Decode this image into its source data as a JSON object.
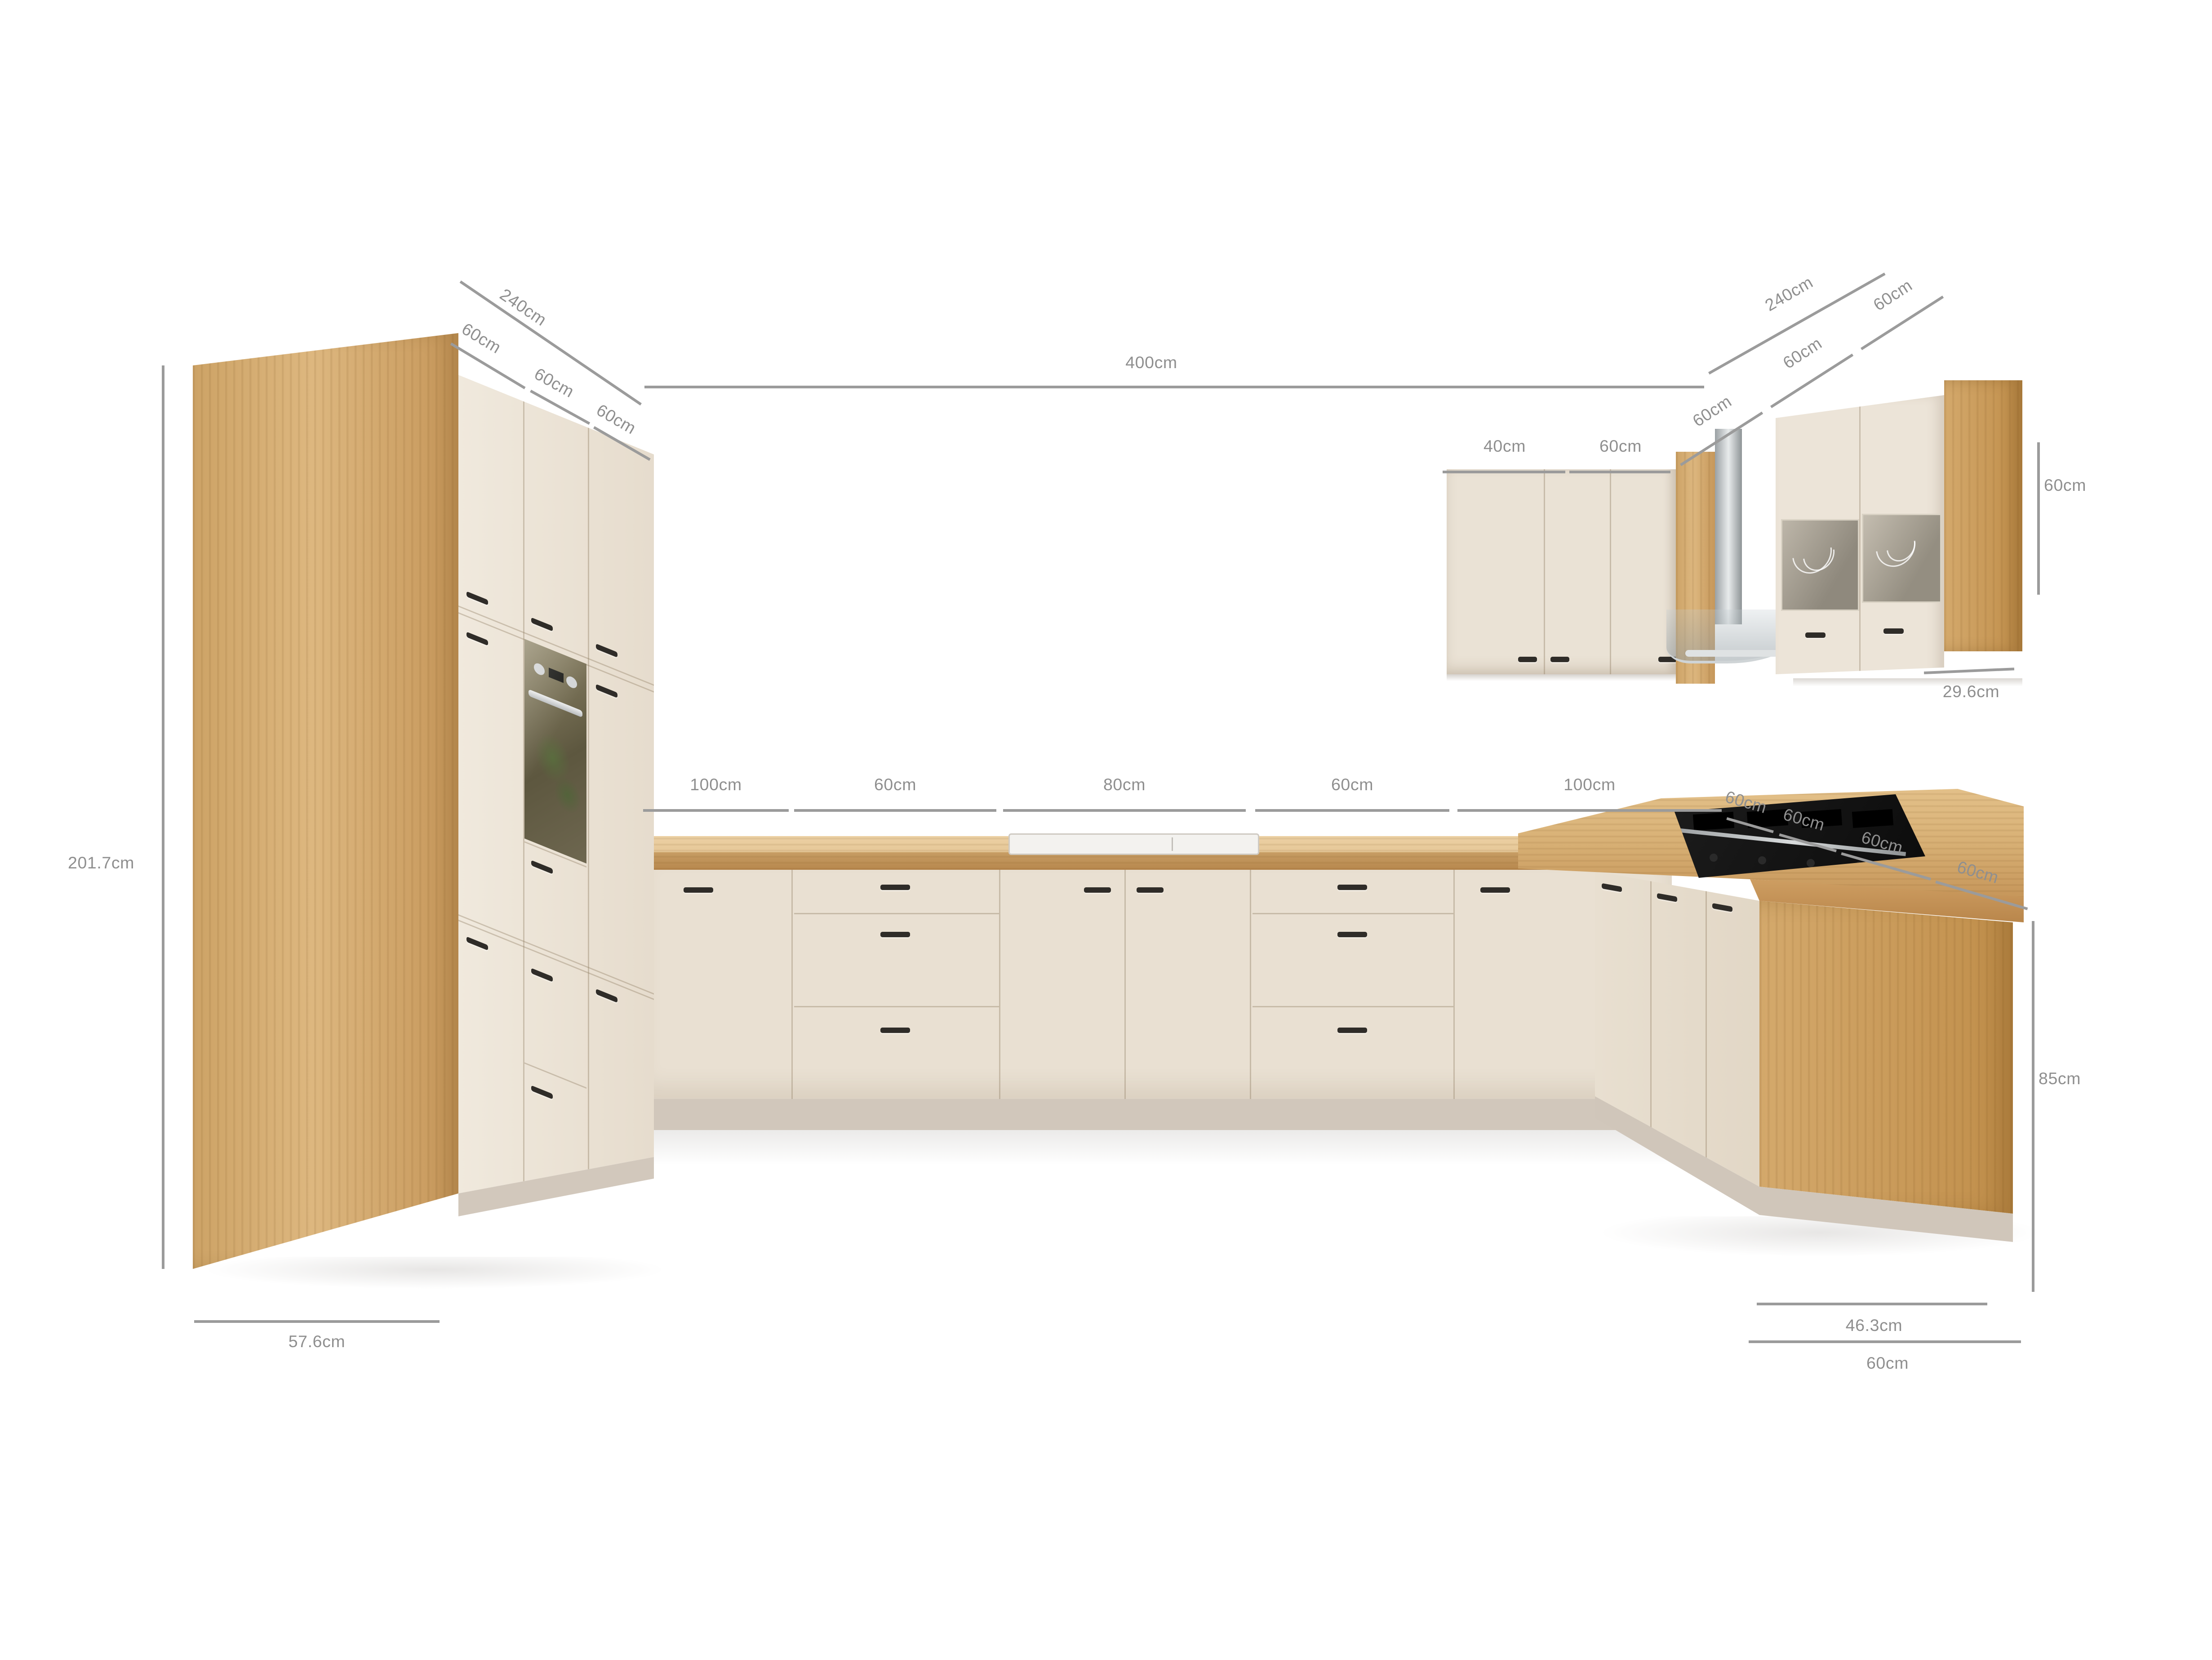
{
  "colors": {
    "wood": "#d2a76c",
    "countertop": "#d8b076",
    "cabinet_cream": "#eae2d5",
    "plinth": "#d1c7bb",
    "handle": "#2f2c28",
    "dim_line": "#9b9b9b",
    "dim_text": "#8f8f8f",
    "hob": "#141414",
    "steel": "#dfe2e3",
    "oven_glass": "#6e6750"
  },
  "dims": {
    "left_total": "240cm",
    "left_segs": [
      "60cm",
      "60cm",
      "60cm"
    ],
    "left_height": "201.7cm",
    "left_depth": "57.6cm",
    "back_total": "400cm",
    "back_segs": [
      "100cm",
      "60cm",
      "80cm",
      "60cm",
      "100cm"
    ],
    "right_total": "240cm",
    "right_upper_segs": [
      "60cm",
      "60cm",
      "60cm"
    ],
    "wall_left_segs": [
      "40cm",
      "60cm"
    ],
    "wall_height": "60cm",
    "wall_depth": "29.6cm",
    "right_counter_segs": [
      "60cm",
      "60cm",
      "60cm",
      "60cm"
    ],
    "counter_height": "85cm",
    "counter_depth": "46.3cm",
    "base_depth": "60cm"
  }
}
